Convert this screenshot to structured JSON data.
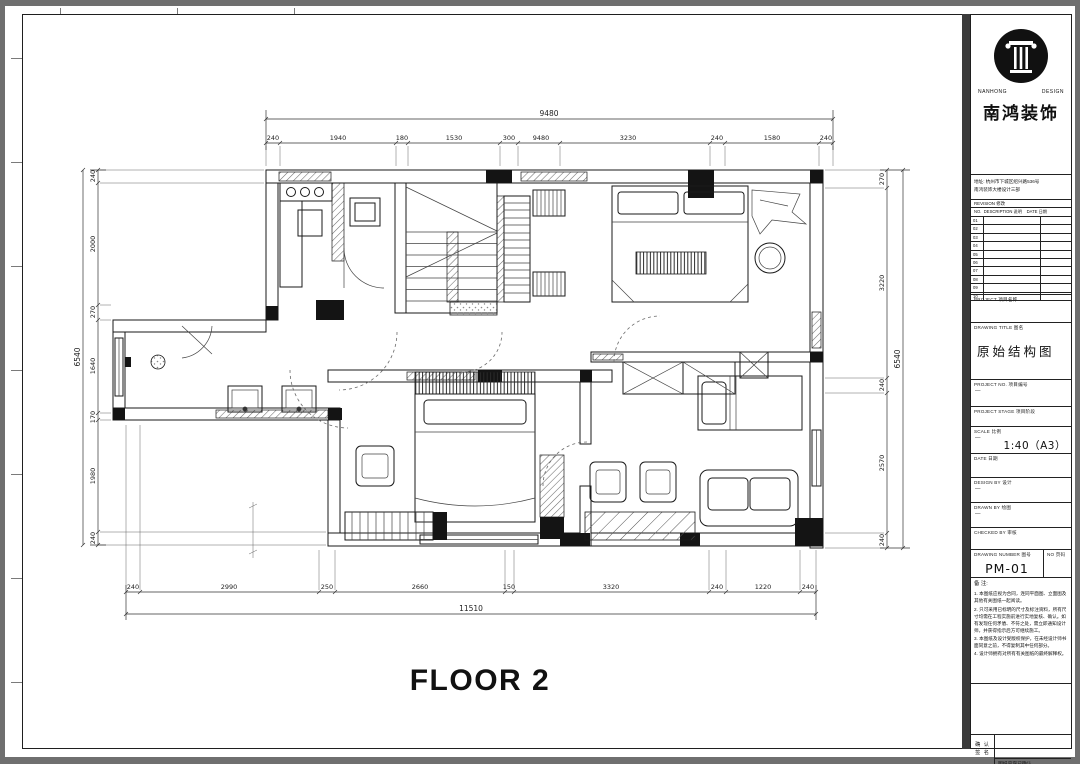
{
  "window": {
    "floor_label": "FLOOR 2"
  },
  "colors": {
    "background": "#6f6f6f",
    "paper": "#ffffff",
    "ink": "#1a1a1a"
  },
  "dims": {
    "top": {
      "overall": "9480",
      "segments": [
        "240",
        "1940",
        "180",
        "1530",
        "300",
        "9480",
        "3230",
        "240",
        "1580",
        "240"
      ]
    },
    "bottom": {
      "overall": "11510",
      "segments": [
        "240",
        "2990",
        "250",
        "2660",
        "150",
        "3320",
        "240",
        "1220",
        "240"
      ]
    },
    "left": {
      "overall": "6540",
      "segments": [
        "240",
        "2000",
        "270",
        "1640",
        "170",
        "1980",
        "240"
      ]
    },
    "right": {
      "overall": "6540",
      "segments": [
        "270",
        "3220",
        "240",
        "2570",
        "240"
      ]
    }
  },
  "title_block": {
    "logo_en_1": "NANHONG",
    "logo_en_2": "DESIGN",
    "logo_cn": "南鸿装饰",
    "address_1": "地址: 杭州市下城区绍兴路536号",
    "address_2": "南鸿装饰大楼设计三部",
    "revision_label": "REVISION 修改",
    "revision_cols": "NO.  DESCRIPTION 说明    DATE 日期",
    "revision_rows": [
      "01",
      "02",
      "03",
      "04",
      "05",
      "06",
      "07",
      "08",
      "09",
      "10"
    ],
    "project_label": "PROJECT 项目名称",
    "drawing_title_label": "DRAWING TITLE 图名",
    "drawing_title": "原始结构图",
    "project_no_label": "PROJECT NO. 项目编号",
    "project_no_value": "—",
    "project_stage_label": "PROJECT STAGE 项目阶段",
    "scale_label": "SCALE 比例",
    "scale_dash": "—",
    "scale_value": "1:40（A3）",
    "date_label": "DATE 日期",
    "design_by_label": "DESIGN BY 设计",
    "design_by_value": "—",
    "drawn_by_label": "DRAWN BY 绘图",
    "drawn_by_value": "—",
    "checked_by_label": "CHECKED BY 审核",
    "drawing_no_label": "DRAWING NUMBER 图号",
    "page_no_label": "NO 页码",
    "drawing_no": "PM-01",
    "notes_title": "备 注:",
    "note_1": "1. 本图纸应视为合同，连同平面图、立面图及其他有关图纸一起阅读。",
    "note_2": "2. 只可采用已标明的尺寸及标注资料，所有尺寸均需在工程实施前进行实地复核、确认。如有发现任何矛盾、不符之处，需立即通知设计师，并获得指示后方可继续施工。",
    "note_3": "3. 本图纸及设计受版权保护，在未经设计师书面同意之前，不得复制其中任何部分。",
    "note_4": "4. 设计师拥有对所有有关图纸的最终解释权。",
    "confirm_line_1": "确 认",
    "confirm_line_2": "签 名",
    "confirm_note": "图纸内容已确认"
  }
}
